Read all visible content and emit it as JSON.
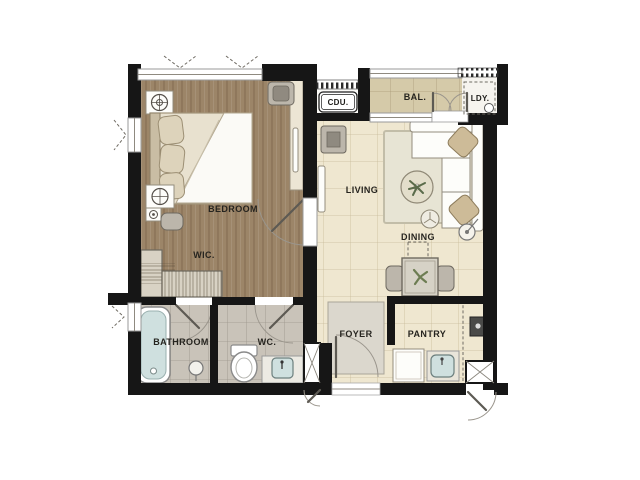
{
  "view": {
    "type": "apartment-unit-floor-plan",
    "background": "#ffffff"
  },
  "rooms": {
    "bedroom": {
      "label": "BEDROOM"
    },
    "wic": {
      "label": "WIC."
    },
    "living": {
      "label": "LIVING"
    },
    "dining": {
      "label": "DINING"
    },
    "balcony": {
      "label": "BAL."
    },
    "cdu": {
      "label": "CDU."
    },
    "laundry": {
      "label": "LDY."
    },
    "bathroom": {
      "label": "BATHROOM"
    },
    "wc": {
      "label": "WC."
    },
    "foyer": {
      "label": "FOYER"
    },
    "pantry": {
      "label": "PANTRY"
    }
  },
  "colors": {
    "wall": "#161616",
    "wood_floor": "#9c8568",
    "tile_cream": "#efe7d0",
    "tile_gray": "#c9c3b9",
    "tile_balcony": "#d5caa9",
    "laundry_floor": "#f6f4ef",
    "cdu_floor": "#fbfaf7",
    "rug": "#e7e4d4",
    "foyer_mat": "#dbd7cd",
    "water_blue": "#cfe0df",
    "cushion_tan": "#cdbb98",
    "desk_cream": "#ece5d4"
  },
  "fixtures": [
    "air-conditioner-icon",
    "bed-icon",
    "pillow-icon",
    "nightstand-lamp-icon",
    "desk-chair-icon",
    "wardrobe-icon",
    "tv-cabinet-icon",
    "wall-shelf-icon",
    "rug-icon",
    "sofa-icon",
    "coffee-table-plant-icon",
    "side-stool-icon",
    "floor-lamp-icon",
    "dining-table-icon",
    "dining-chair-icon",
    "bathtub-icon",
    "floor-drain-icon",
    "toilet-icon",
    "washbasin-icon",
    "washing-machine-icon",
    "refrigerator-icon",
    "kitchen-sink-icon",
    "cooktop-icon",
    "door-swing-icon",
    "double-balcony-door-icon",
    "casement-window-icon",
    "louver-vent-icon",
    "utility-shaft-icon"
  ]
}
